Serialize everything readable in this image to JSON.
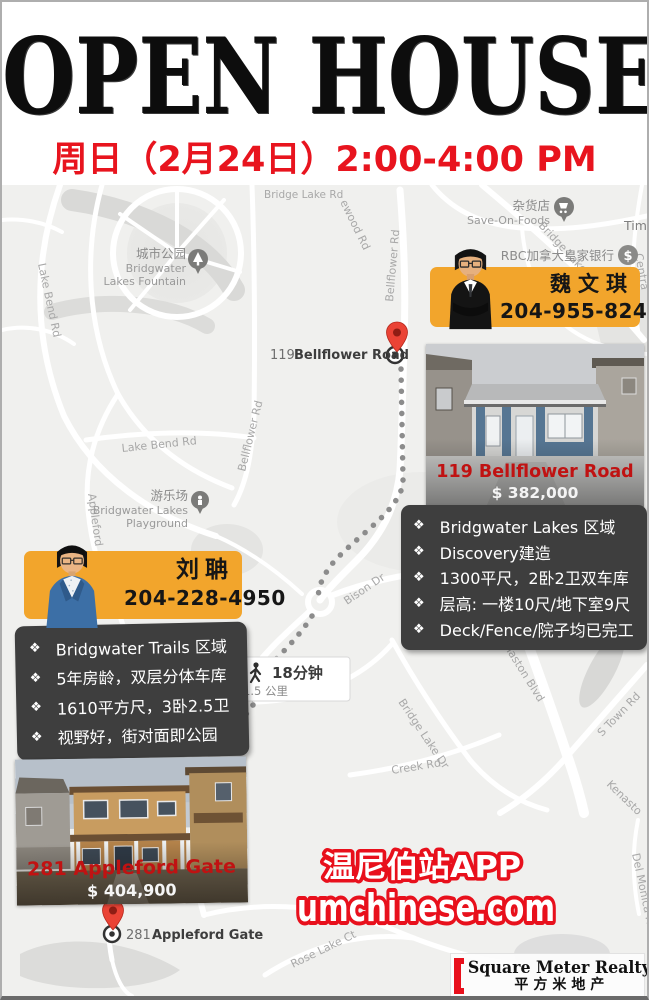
{
  "header": {
    "title": "OPEN HOUSE",
    "subtitle": "周日（2月24日）2:00-4:00 PM"
  },
  "agents": [
    {
      "name": "魏文琪",
      "phone": "204-955-8246"
    },
    {
      "name": "刘聃",
      "phone": "204-228-4950"
    }
  ],
  "listings": [
    {
      "address": "119 Bellflower Road",
      "price": "$ 382,000",
      "features": [
        "Bridgwater Lakes 区域",
        "Discovery建造",
        "1300平尺，2卧2卫双车库",
        "层高: 一楼10尺/地下室9尺",
        "Deck/Fence/院子均已完工"
      ]
    },
    {
      "address": "281 Appleford Gate",
      "price": "$ 404,900",
      "features": [
        "Bridgwater Trails 区域",
        "5年房龄，双层分体车库",
        "1610平方尺，3卧2.5卫",
        "视野好，街对面即公园"
      ]
    }
  ],
  "bullet": "❖",
  "map": {
    "markers": [
      {
        "number": "119",
        "name": "Bellflower Road"
      },
      {
        "number": "281",
        "name": "Appleford Gate"
      }
    ],
    "walk": {
      "duration": "18分钟",
      "distance": "1.5 公里"
    },
    "pois": {
      "fountain": {
        "zh": "城市公园",
        "en1": "Bridgwater",
        "en2": "Lakes Fountain"
      },
      "grocery": {
        "zh": "杂货店",
        "en": "Save-On-Foods"
      },
      "bank": {
        "zh": "RBC加拿大皇家银行",
        "icon": "$"
      },
      "tim": "Tim",
      "playground": {
        "zh": "游乐场",
        "en1": "Bridgwater Lakes",
        "en2": "Playground"
      }
    },
    "roads": {
      "lakeBend1": "Lake Bend Rd",
      "lakeBend2": "Lake Bend Rd",
      "bellflower1": "Bellflower Rd",
      "bellflower2": "Bellflower Rd",
      "ewood": "ewood Rd",
      "bridgeLakeRd": "Bridge Lake Rd",
      "bridgeLakeTop": "Bridge Lake Dr",
      "centra": "Centra",
      "bison": "Bison Dr",
      "kenaston1": "Kenaston Blvd",
      "kenaston2": "Kenasto",
      "sTown": "S Town Rd",
      "bridgeLake2": "Bridge Lake Dr",
      "creek": "Creek Rd",
      "barkfield": "Barkfield Rd",
      "roseLake": "Rose Lake Ct",
      "delMonica": "Del Monica Rd",
      "appleford": "Appleford"
    }
  },
  "promo": {
    "line1": "温尼伯站APP",
    "line2": "umchinese.com"
  },
  "logo": {
    "en": "Square Meter Realty",
    "zh": "平方米地产"
  },
  "colors": {
    "accent_yellow": "#f2a52c",
    "accent_red": "#e8141e",
    "box_dark": "#3e3e3e",
    "pin_red": "#ea4335",
    "photo_red": "#c01212"
  }
}
